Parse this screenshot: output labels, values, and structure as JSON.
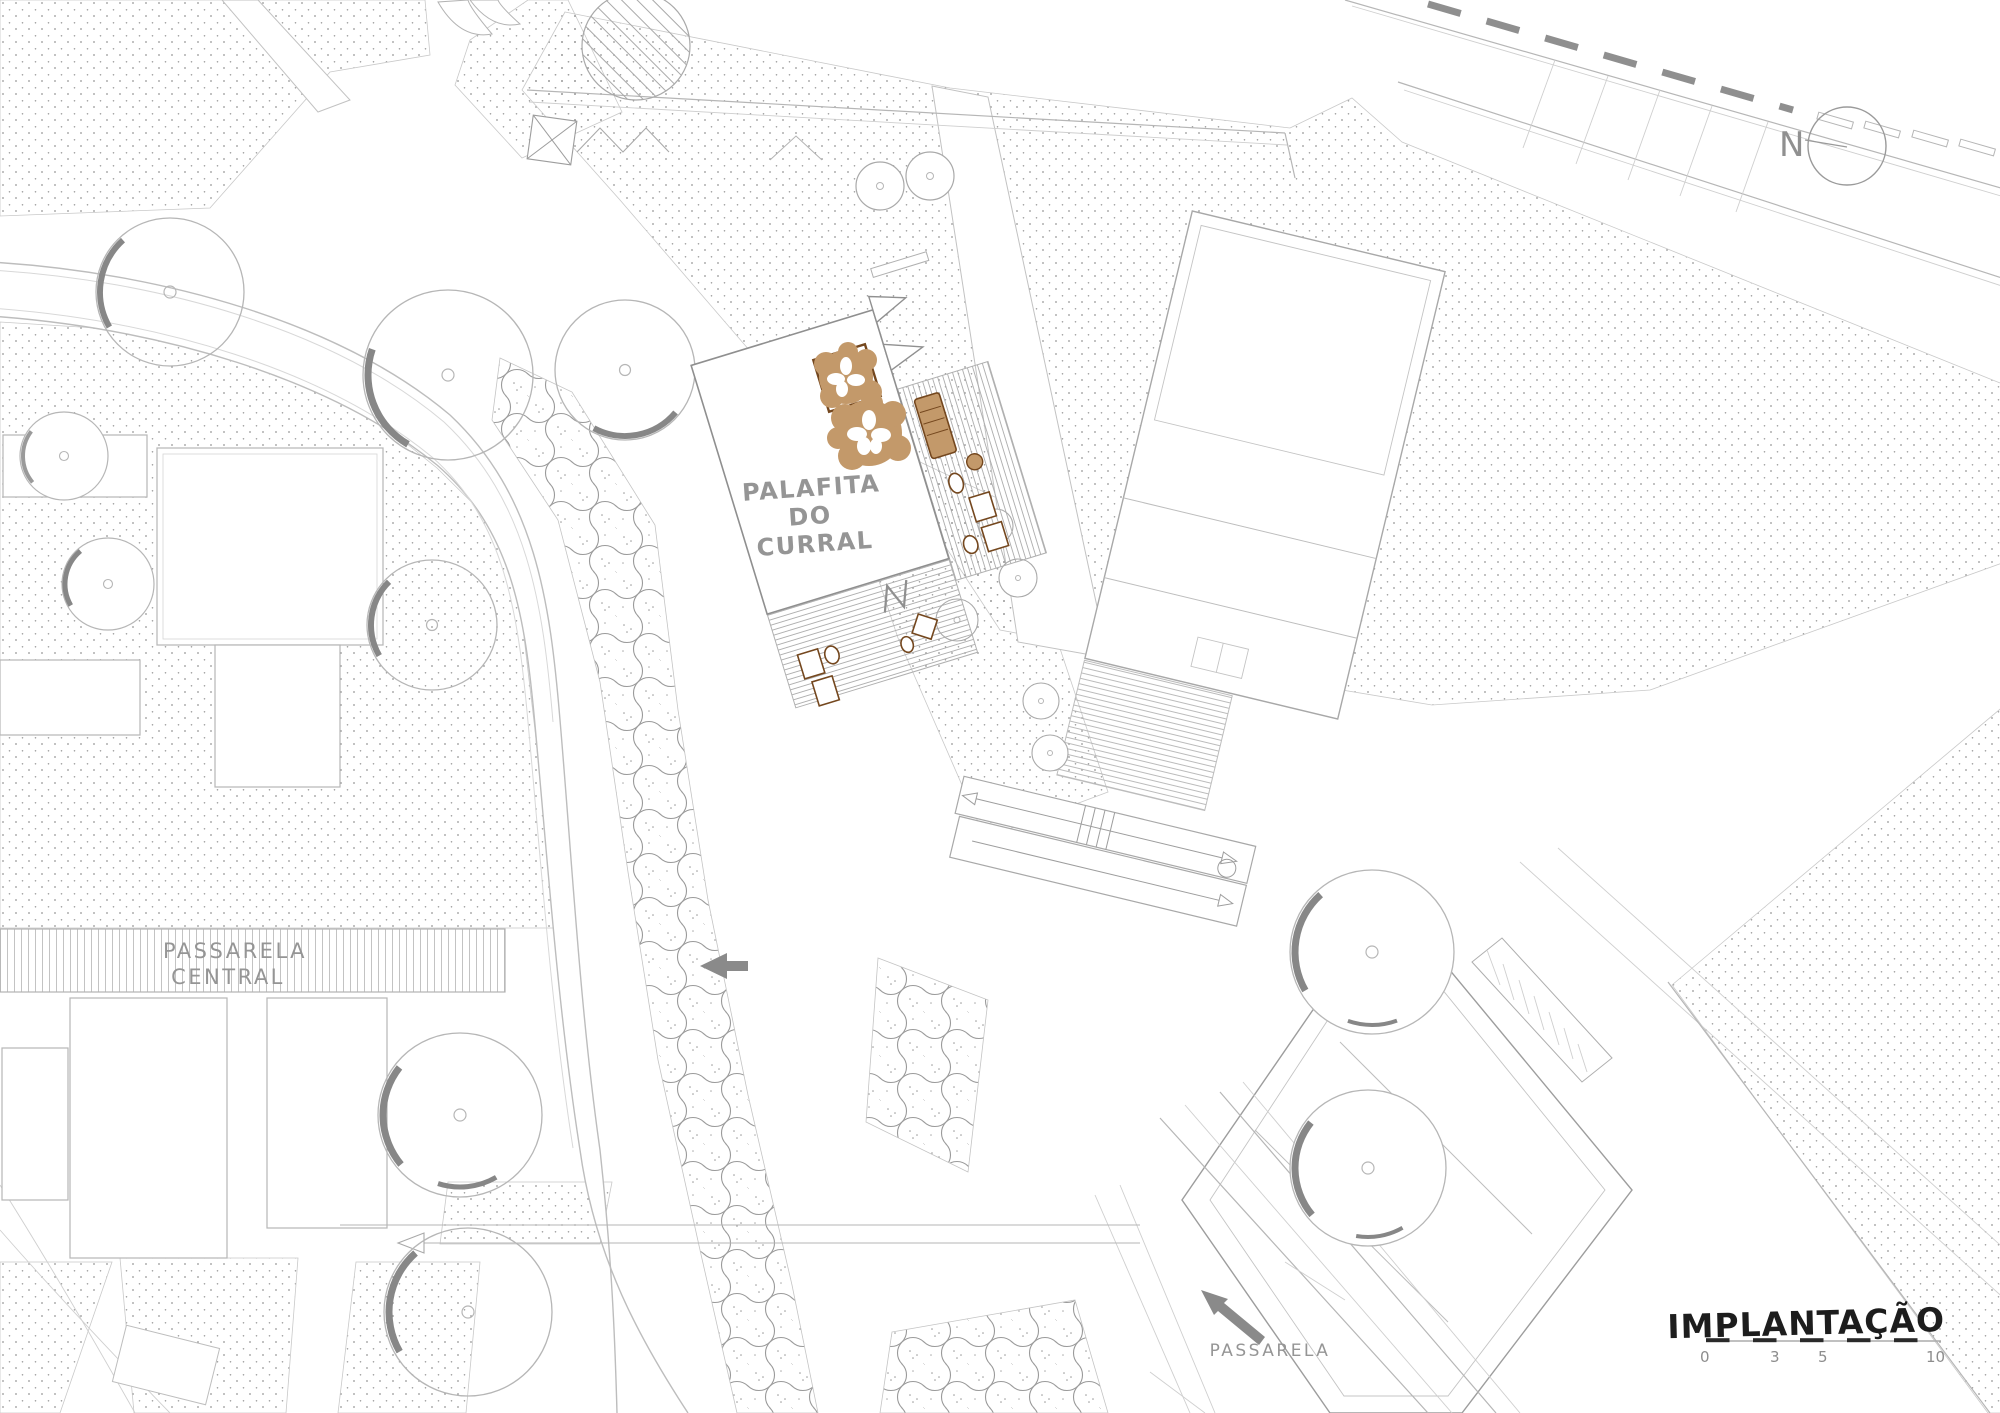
{
  "plan": {
    "building_label": {
      "line1": "PALAFITA",
      "line2": "DO",
      "line3": "CURRAL"
    },
    "central_walkway_label": {
      "line1": "PASSARELA",
      "line2": "CENTRAL"
    },
    "walkway_label": "PASSARELA",
    "north_label": "N",
    "title_block": {
      "title": "IMPLANTAÇÃO",
      "scale_ticks": [
        "0",
        "3",
        "5",
        "10"
      ]
    },
    "colors": {
      "line_gray": "#b6b6b6",
      "dark_gray": "#8d8d8d",
      "text_gray": "#959595",
      "title_black": "#1d1d1d",
      "tree_brown": "#c3996a",
      "furniture_brown": "#74471e",
      "shadow_gray": "#878787"
    }
  }
}
